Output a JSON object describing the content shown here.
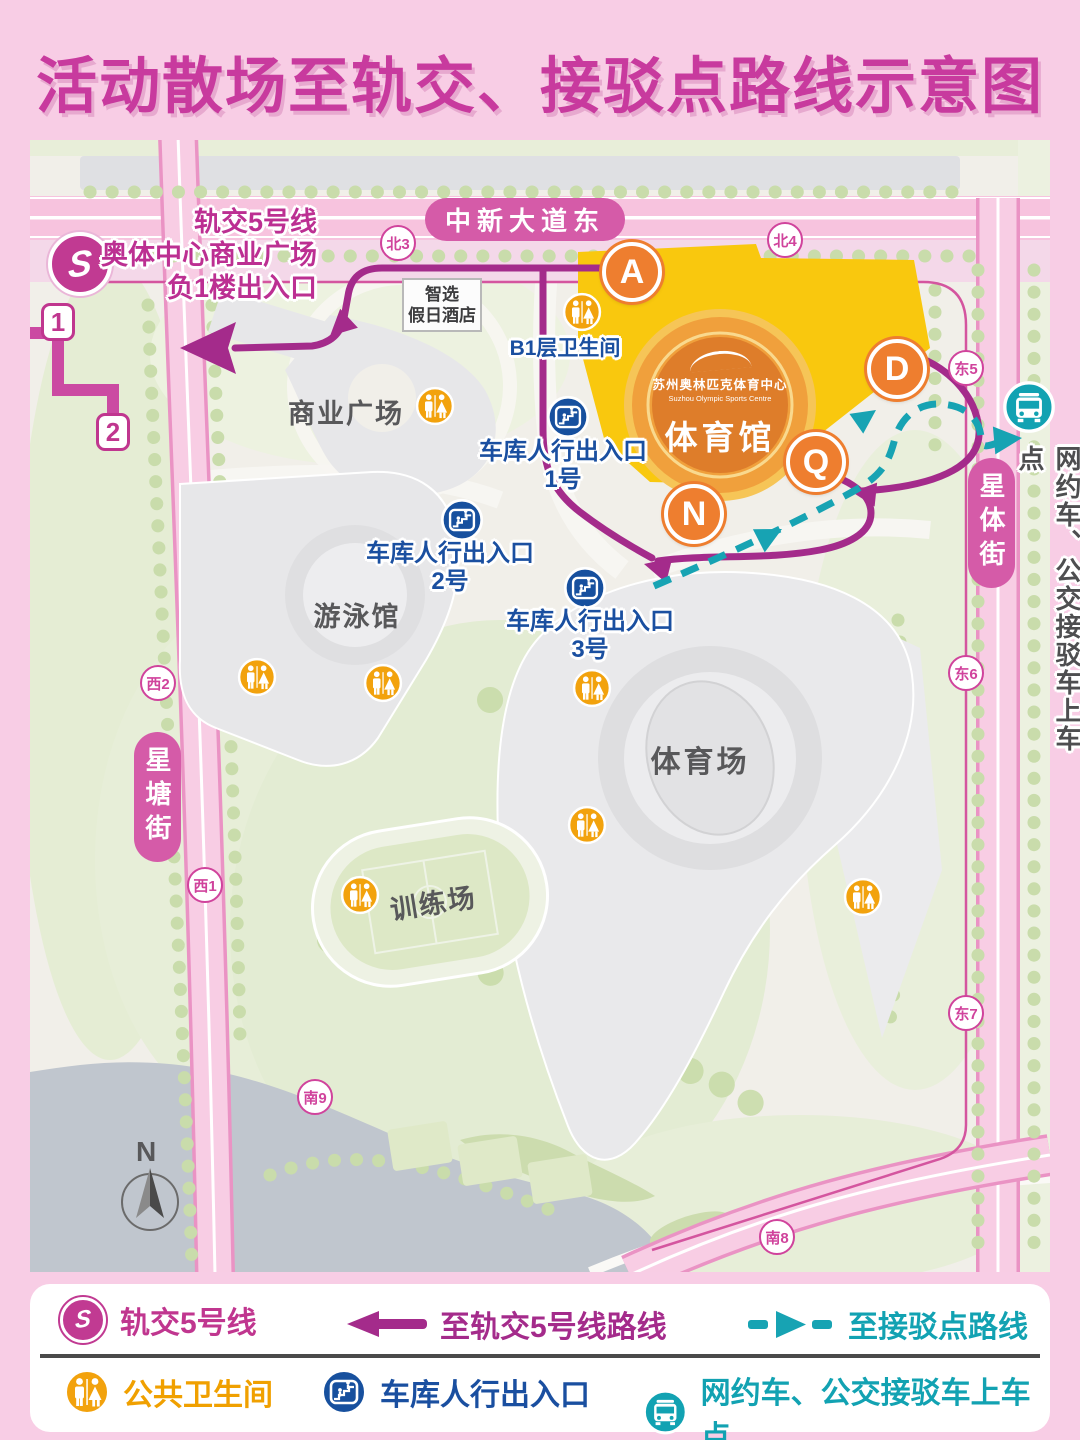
{
  "title": "活动散场至轨交、接驳点路线示意图",
  "colors": {
    "brand_magenta": "#c0368f",
    "route_to_rail": "#a42b8b",
    "route_to_shuttle": "#17a3b3",
    "toilet_orange": "#f2a20d",
    "garage_blue": "#17509e",
    "gate_orange": "#ee7e2f",
    "road_pink": "#f7c3de"
  },
  "streets": {
    "north": "中新大道东",
    "west": "星塘街",
    "east": "星体街"
  },
  "road_badges": [
    "北3",
    "北4",
    "东5",
    "东6",
    "东7",
    "西2",
    "西1",
    "南9",
    "南8"
  ],
  "metro": {
    "logo_letter": "S",
    "exit1": "1",
    "exit2": "2",
    "info": [
      "轨交5号线",
      "奥体中心商业广场",
      "负1楼出入口"
    ]
  },
  "gates": {
    "a": "A",
    "d": "D",
    "q": "Q",
    "n": "N"
  },
  "buildings": {
    "hotel": [
      "智选",
      "假日酒店"
    ],
    "plaza": "商业广场",
    "gym_cn": "苏州奥林匹克体育中心",
    "gym_en": "Suzhou Olympic Sports Centre",
    "gym": "体育馆",
    "pool": "游泳馆",
    "stadium": "体育场",
    "training": "训练场"
  },
  "labels": {
    "b1_toilet": "B1层卫生间",
    "garage_line1": "车库人行出入口",
    "garage1": "1号",
    "garage2": "2号",
    "garage3": "3号",
    "pickup_point": "网约车、公交接驳车上车点",
    "compass_north": "N"
  },
  "legend": {
    "rail": "轨交5号线",
    "to_rail": "至轨交5号线路线",
    "to_shuttle": "至接驳点路线",
    "toilet": "公共卫生间",
    "garage": "车库人行出入口",
    "pickup": "网约车、公交接驳车上车点"
  }
}
